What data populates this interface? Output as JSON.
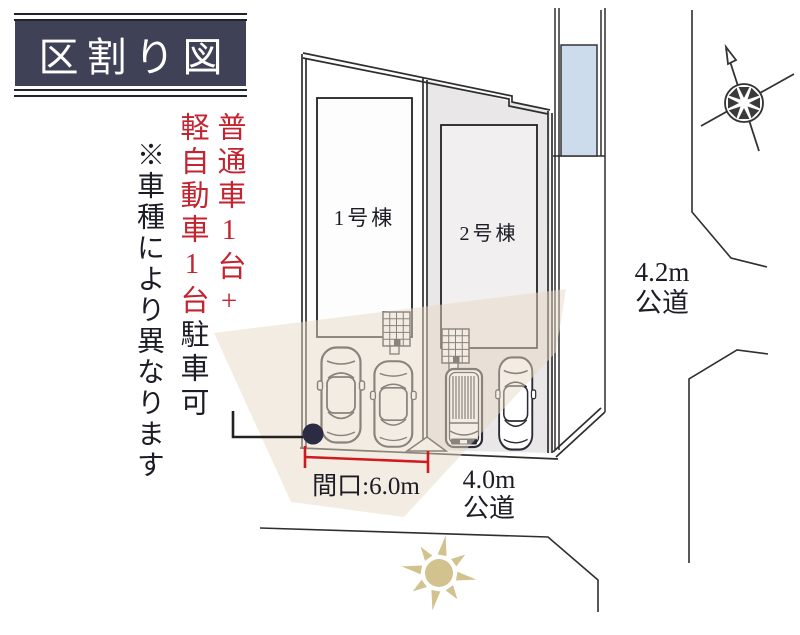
{
  "diagram": {
    "title": "区割り図",
    "parking_note": {
      "line1": "普通車1台+",
      "line2_red": "軽自動車1台",
      "line2_black": "駐車可",
      "disclaimer": "※車種により異なります"
    },
    "buildings": [
      {
        "label": "1号棟"
      },
      {
        "label": "2号棟"
      }
    ],
    "frontage_label": "間口:6.0m",
    "roads": {
      "south": {
        "width": "4.0m",
        "type": "公道"
      },
      "east": {
        "width": "4.2m",
        "type": "公道"
      }
    },
    "icons": [
      "north-compass-icon",
      "sun-icon",
      "boundary-dot-marker",
      "car-top-view",
      "kei-van-top-view",
      "entrance-tile-grid"
    ],
    "colors": {
      "accent_red": "#c32430",
      "dimension_red": "#d11a1f",
      "title_bg": "#3f4156",
      "plot2_fill": "#e9e7e7",
      "building_fill": "#f1efef",
      "neighbor_blue": "#ccdcec",
      "sun_tan": "#d2c28e",
      "light_beige": "#e7d9c5",
      "marker_navy": "#2b2b43",
      "line": "#2e2e2e"
    }
  }
}
